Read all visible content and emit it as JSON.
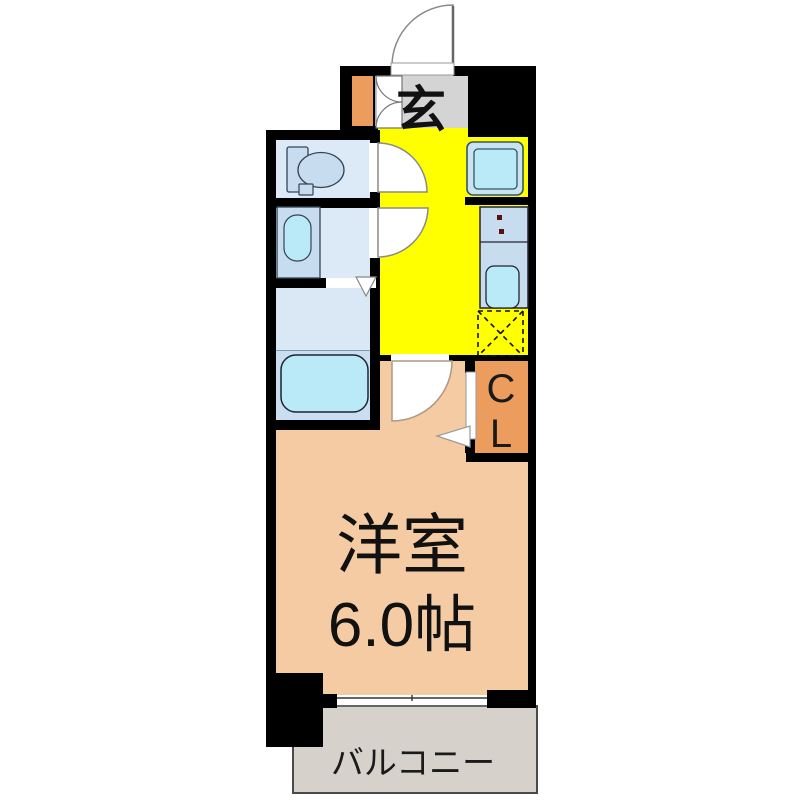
{
  "plan": {
    "entrance_label": "玄",
    "closet_label": "CL",
    "room_name": "洋室",
    "room_size": "6.0帖",
    "balcony_label": "バルコニー",
    "colors": {
      "wall": "#000000",
      "kitchen": "#FFFF00",
      "main_room": "#F4CBA3",
      "closet": "#EC9D5E",
      "entrance_floor": "#D4D4D4",
      "balcony": "#D6D1CB",
      "wet_rooms": "#DCEAF7",
      "vanity_counter": "#C7DCEF",
      "fixtures": "#BAEAF7",
      "bath_lower": "#C9DEF0"
    }
  }
}
